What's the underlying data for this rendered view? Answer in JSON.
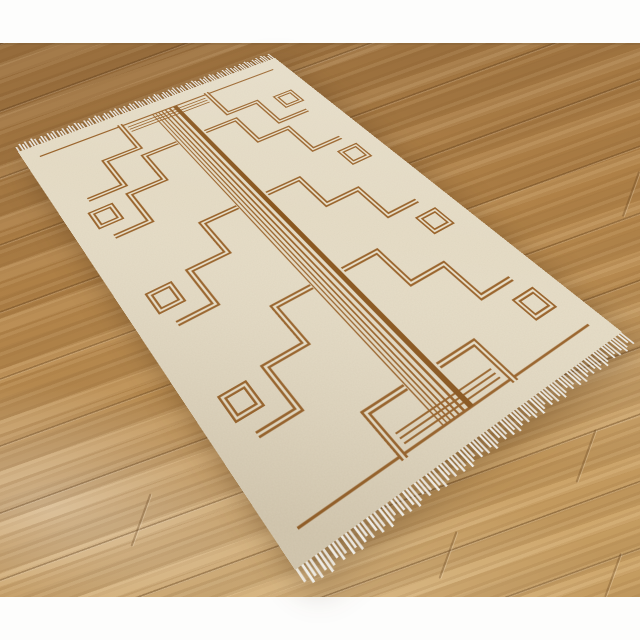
{
  "scene_type": "product-photo-rug-on-wood-floor",
  "colors": {
    "wall": "#fdfdfc",
    "floor_dark": "#9d7240",
    "floor_mid": "#b4854a",
    "floor_light": "#cba265",
    "rug_base": "#e8dfc9",
    "rug_brown": "#99632a",
    "rug_brown_dark": "#8a571f",
    "fringe": "#f2f2ee"
  },
  "rug": {
    "width": 400,
    "height": 600,
    "clip": {
      "x": 16,
      "y": 18,
      "w": 368,
      "h": 564
    },
    "end_lines": [
      {
        "x1": 20,
        "y": 24,
        "x2": 380,
        "w": 2.5
      },
      {
        "x1": 20,
        "y": 576,
        "x2": 380,
        "w": 2.5
      }
    ],
    "end_accent_lines": [
      {
        "x1": 140,
        "y": 31,
        "x2": 260,
        "w": 1.8
      },
      {
        "x1": 140,
        "y": 36.5,
        "x2": 260,
        "w": 1.8
      },
      {
        "x1": 140,
        "y": 42,
        "x2": 260,
        "w": 1.8
      },
      {
        "x1": 140,
        "y": 558,
        "x2": 260,
        "w": 1.8
      },
      {
        "x1": 140,
        "y": 563.5,
        "x2": 260,
        "w": 1.8
      },
      {
        "x1": 140,
        "y": 569,
        "x2": 260,
        "w": 1.8
      }
    ],
    "center_stripes": {
      "y1": 24,
      "y2": 576,
      "x": [
        180.5,
        185,
        189.5,
        194.5,
        200,
        206.5,
        215
      ],
      "w": [
        1.5,
        1.5,
        1.7,
        1.9,
        2.2,
        2.8,
        6.2
      ]
    },
    "meanders_left": [
      "M 133 20 V 78 H 85 V 132 H 38",
      "M 179 96 H 131 V 150 H 83 V 204 H 38",
      "M 179 240 H 131 V 294 H 83 V 348 H 38",
      "M 179 384 H 131 V 438 H 83 V 492 H 38",
      "M 179 528 H 131 V 580"
    ],
    "meanders_right": [
      "M 267 20 V 78 H 315 V 132 H 362",
      "M 221 96 H 269 V 150 H 317 V 204 H 362",
      "M 221 240 H 269 V 294 H 317 V 348 H 362",
      "M 221 384 H 269 V 438 H 317 V 492 H 362",
      "M 221 528 H 269 V 580"
    ],
    "meander_stroke_outer": 7.5,
    "meander_stroke_inner": 2.6,
    "border_squares": [
      {
        "cx": 44,
        "cy": 168,
        "s": 25
      },
      {
        "cx": 44,
        "cy": 312,
        "s": 25
      },
      {
        "cx": 44,
        "cy": 456,
        "s": 25
      },
      {
        "cx": 356,
        "cy": 96,
        "s": 25
      },
      {
        "cx": 356,
        "cy": 240,
        "s": 25
      },
      {
        "cx": 356,
        "cy": 384,
        "s": 25
      },
      {
        "cx": 356,
        "cy": 528,
        "s": 25
      }
    ],
    "fringe": {
      "spacing": 4.3,
      "width": 2.2,
      "base_length": 11,
      "count": 93
    }
  },
  "floor_joints": [
    {
      "x": 140,
      "y": 492,
      "h": 56
    },
    {
      "x": 585,
      "y": 428,
      "h": 56
    },
    {
      "x": 447,
      "y": 530,
      "h": 50
    },
    {
      "x": 612,
      "y": 552,
      "h": 46
    },
    {
      "x": 630,
      "y": 170,
      "h": 48
    }
  ]
}
